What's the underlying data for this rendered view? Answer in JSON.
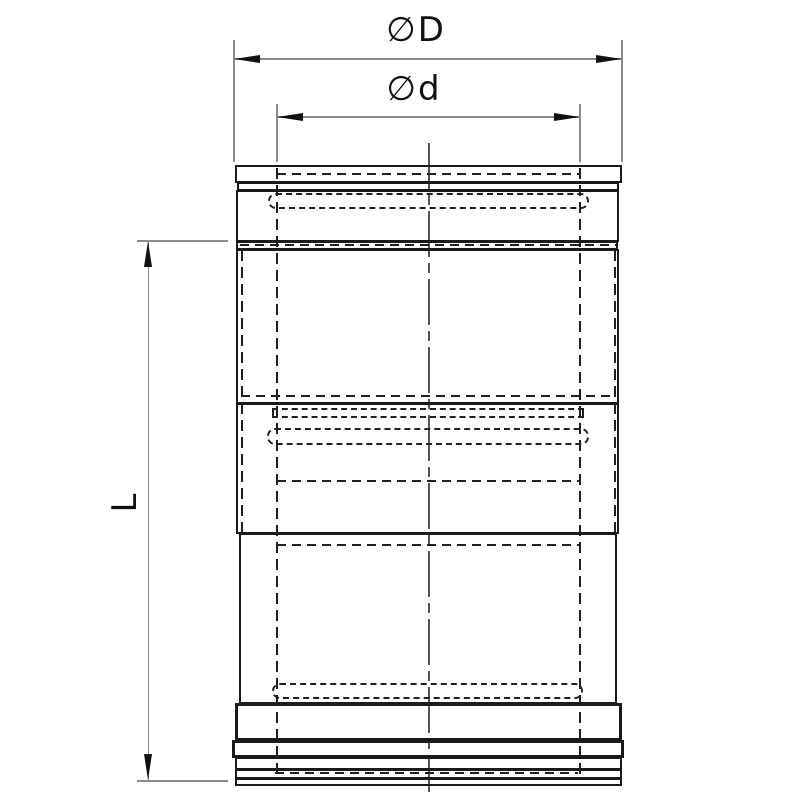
{
  "drawing": {
    "dimension_labels": {
      "outer_diameter": "∅D",
      "inner_diameter": "∅d",
      "length": "L"
    },
    "colors": {
      "body_line": "#1a1a1a",
      "hidden_line": "#1f1f1f",
      "dimension_line": "#8c8c8c",
      "arrow": "#111111",
      "background": "#ffffff"
    }
  }
}
